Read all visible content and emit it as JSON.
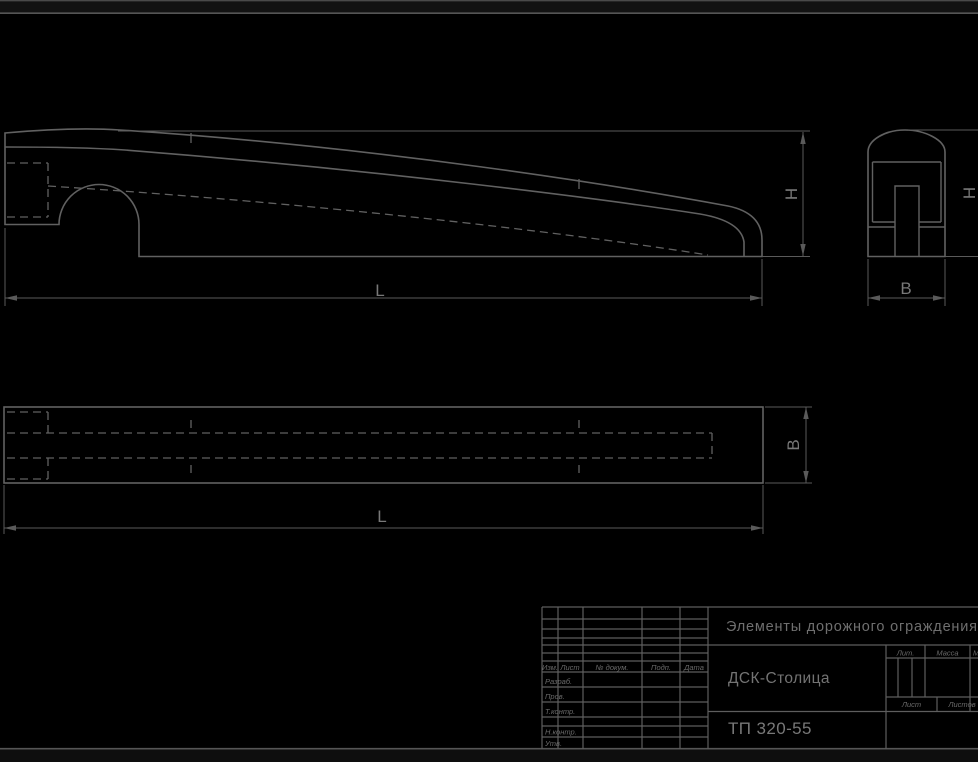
{
  "sheet": {
    "project_title": "Элементы дорожного ограждения",
    "organization": "ДСК-Столица",
    "document_code": "ТП 320-55"
  },
  "dimension_labels": {
    "length": "L",
    "height": "H",
    "width": "B"
  },
  "title_block": {
    "revision_header": {
      "izm": "Изм.",
      "list": "Лист",
      "doc": "№ докум.",
      "podp": "Подп.",
      "data": "Дата"
    },
    "roles": {
      "razrab": "Разраб.",
      "prov": "Пров.",
      "tkontr": "Т.контр.",
      "nkontr": "Н.контр.",
      "utv": "Утв."
    },
    "stats": {
      "lit": "Лит.",
      "massa": "Масса",
      "masshtab": "Масштаб",
      "list": "Лист",
      "listov": "Листов"
    }
  },
  "colors": {
    "background": "#000000",
    "line": "#616161",
    "text": "#6f6f6f"
  }
}
